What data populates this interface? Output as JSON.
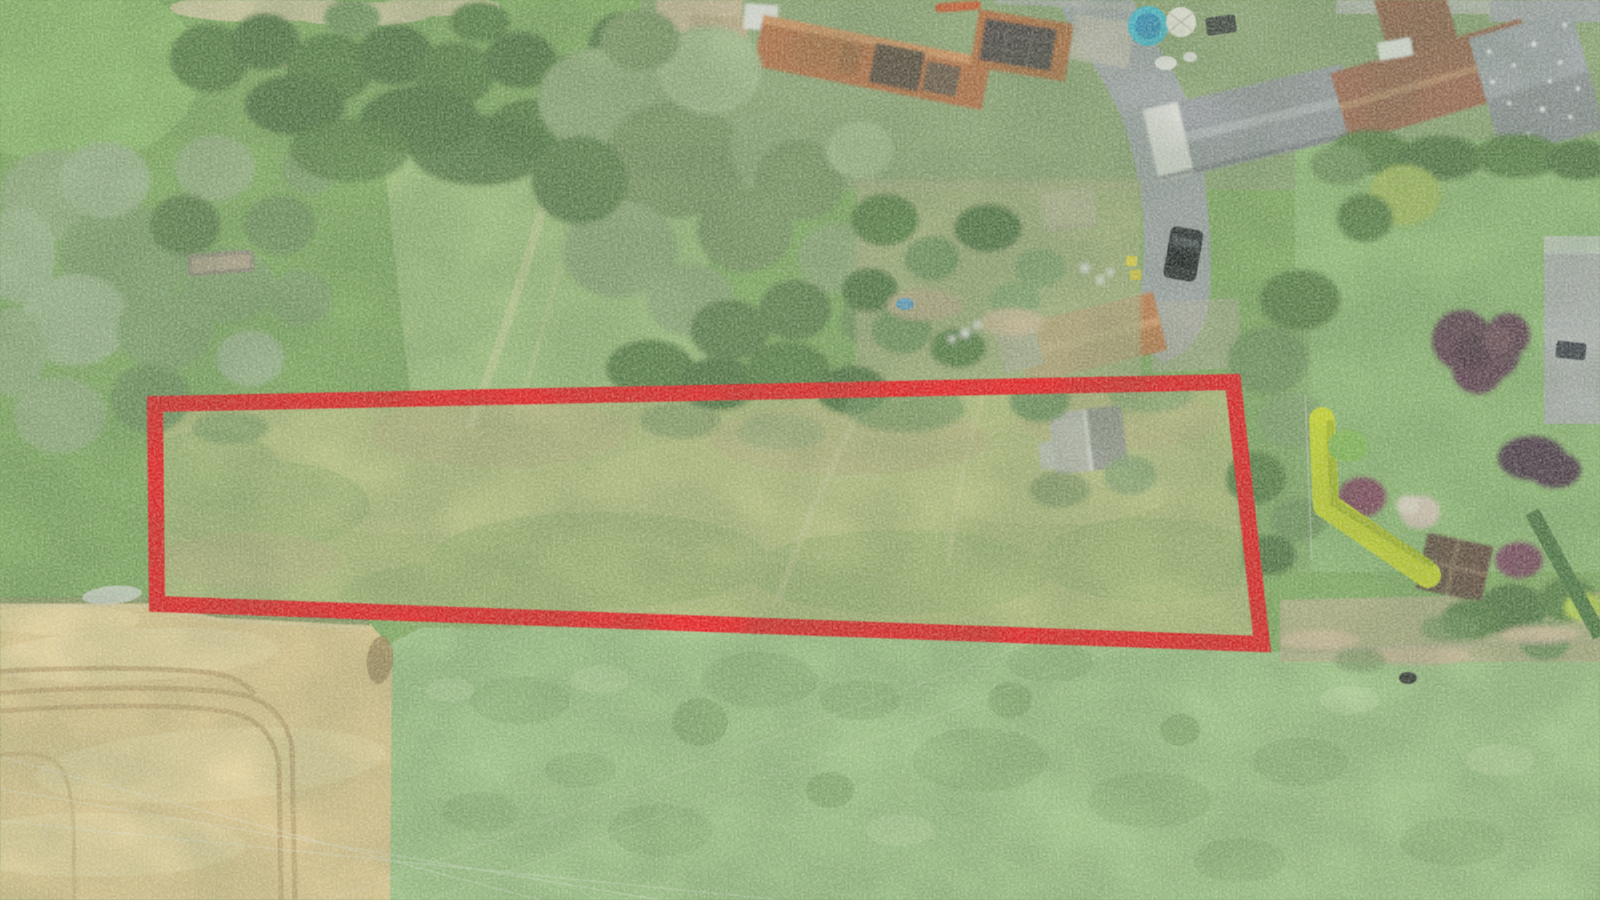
{
  "meta": {
    "type": "aerial-drone-photograph",
    "description": "Bird's-eye drone photo of a village edge: a long grass building plot outlined with a thick red boundary, a wheat field lower left, a large pasture below, houses with orange and grey tiled roofs along the top, gardens and trimmed hedges on the right.",
    "width_px": 1600,
    "height_px": 900
  },
  "annotation": {
    "shape": "quadrilateral",
    "points": "155,404 1233,382 1262,644 157,604",
    "stroke_color": "#e3191d",
    "stroke_width": 16
  },
  "palette": {
    "meadow_green": "#7da65f",
    "parcel_field": "#aab678",
    "pasture_green": "#9cc084",
    "wheat_gold": "#dcc48d",
    "road_gray": "#9ba0a2",
    "roof_orange": "#ad6b42",
    "roof_maroon": "#97644d",
    "roof_gray": "#8f9497",
    "hedge_chartreuse": "#c6d32b",
    "pool_teal": "#45b8cd",
    "car_black": "#23272c",
    "tree_purple": "#5c3b4e"
  },
  "scene": {
    "features": [
      "red-outlined building plot with small grey shed",
      "wheat field with curved tractor tracks (bottom left)",
      "large light-green pasture (bottom)",
      "village houses with orange tiled and grey slate roofs (top)",
      "lane with parked dark van",
      "garden with blue pool, white parasol and trampoline",
      "bright chartreuse trimmed hedge (right)",
      "copper-purple ornamental trees (right garden)",
      "wooden gazebo shed (right)",
      "faint power lines crossing the pasture"
    ]
  }
}
